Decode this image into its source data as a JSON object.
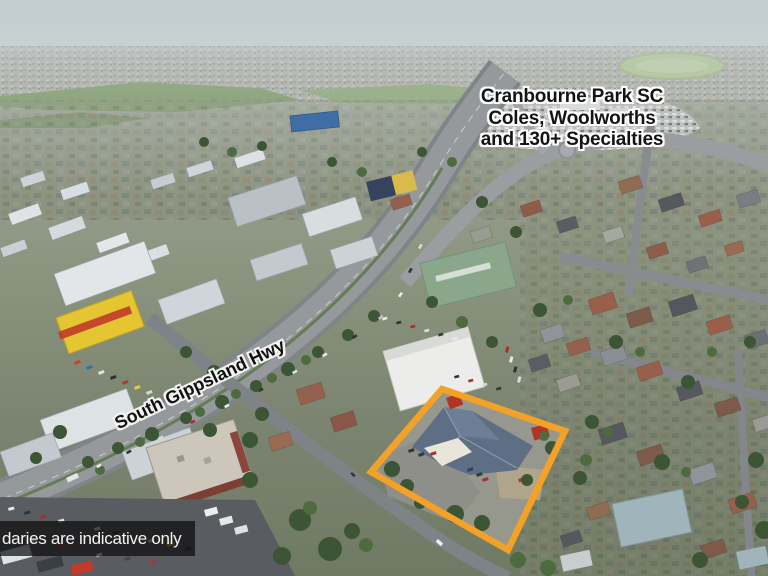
{
  "overlay": {
    "annotation": {
      "line1": "Cranbourne Park SC",
      "line2": "Coles, Woolworths",
      "line3": "and 130+ Specialties"
    },
    "road_label": "South Gippsland Hwy",
    "disclaimer": "daries are indicative only"
  },
  "colors": {
    "boundary_orange": "#F4A227",
    "annotation_text": "#141414",
    "annotation_halo": "#FFFFFF",
    "disclaimer_text": "#F4F4F4",
    "disclaimer_bg": "rgba(12,12,12,0.72)"
  }
}
